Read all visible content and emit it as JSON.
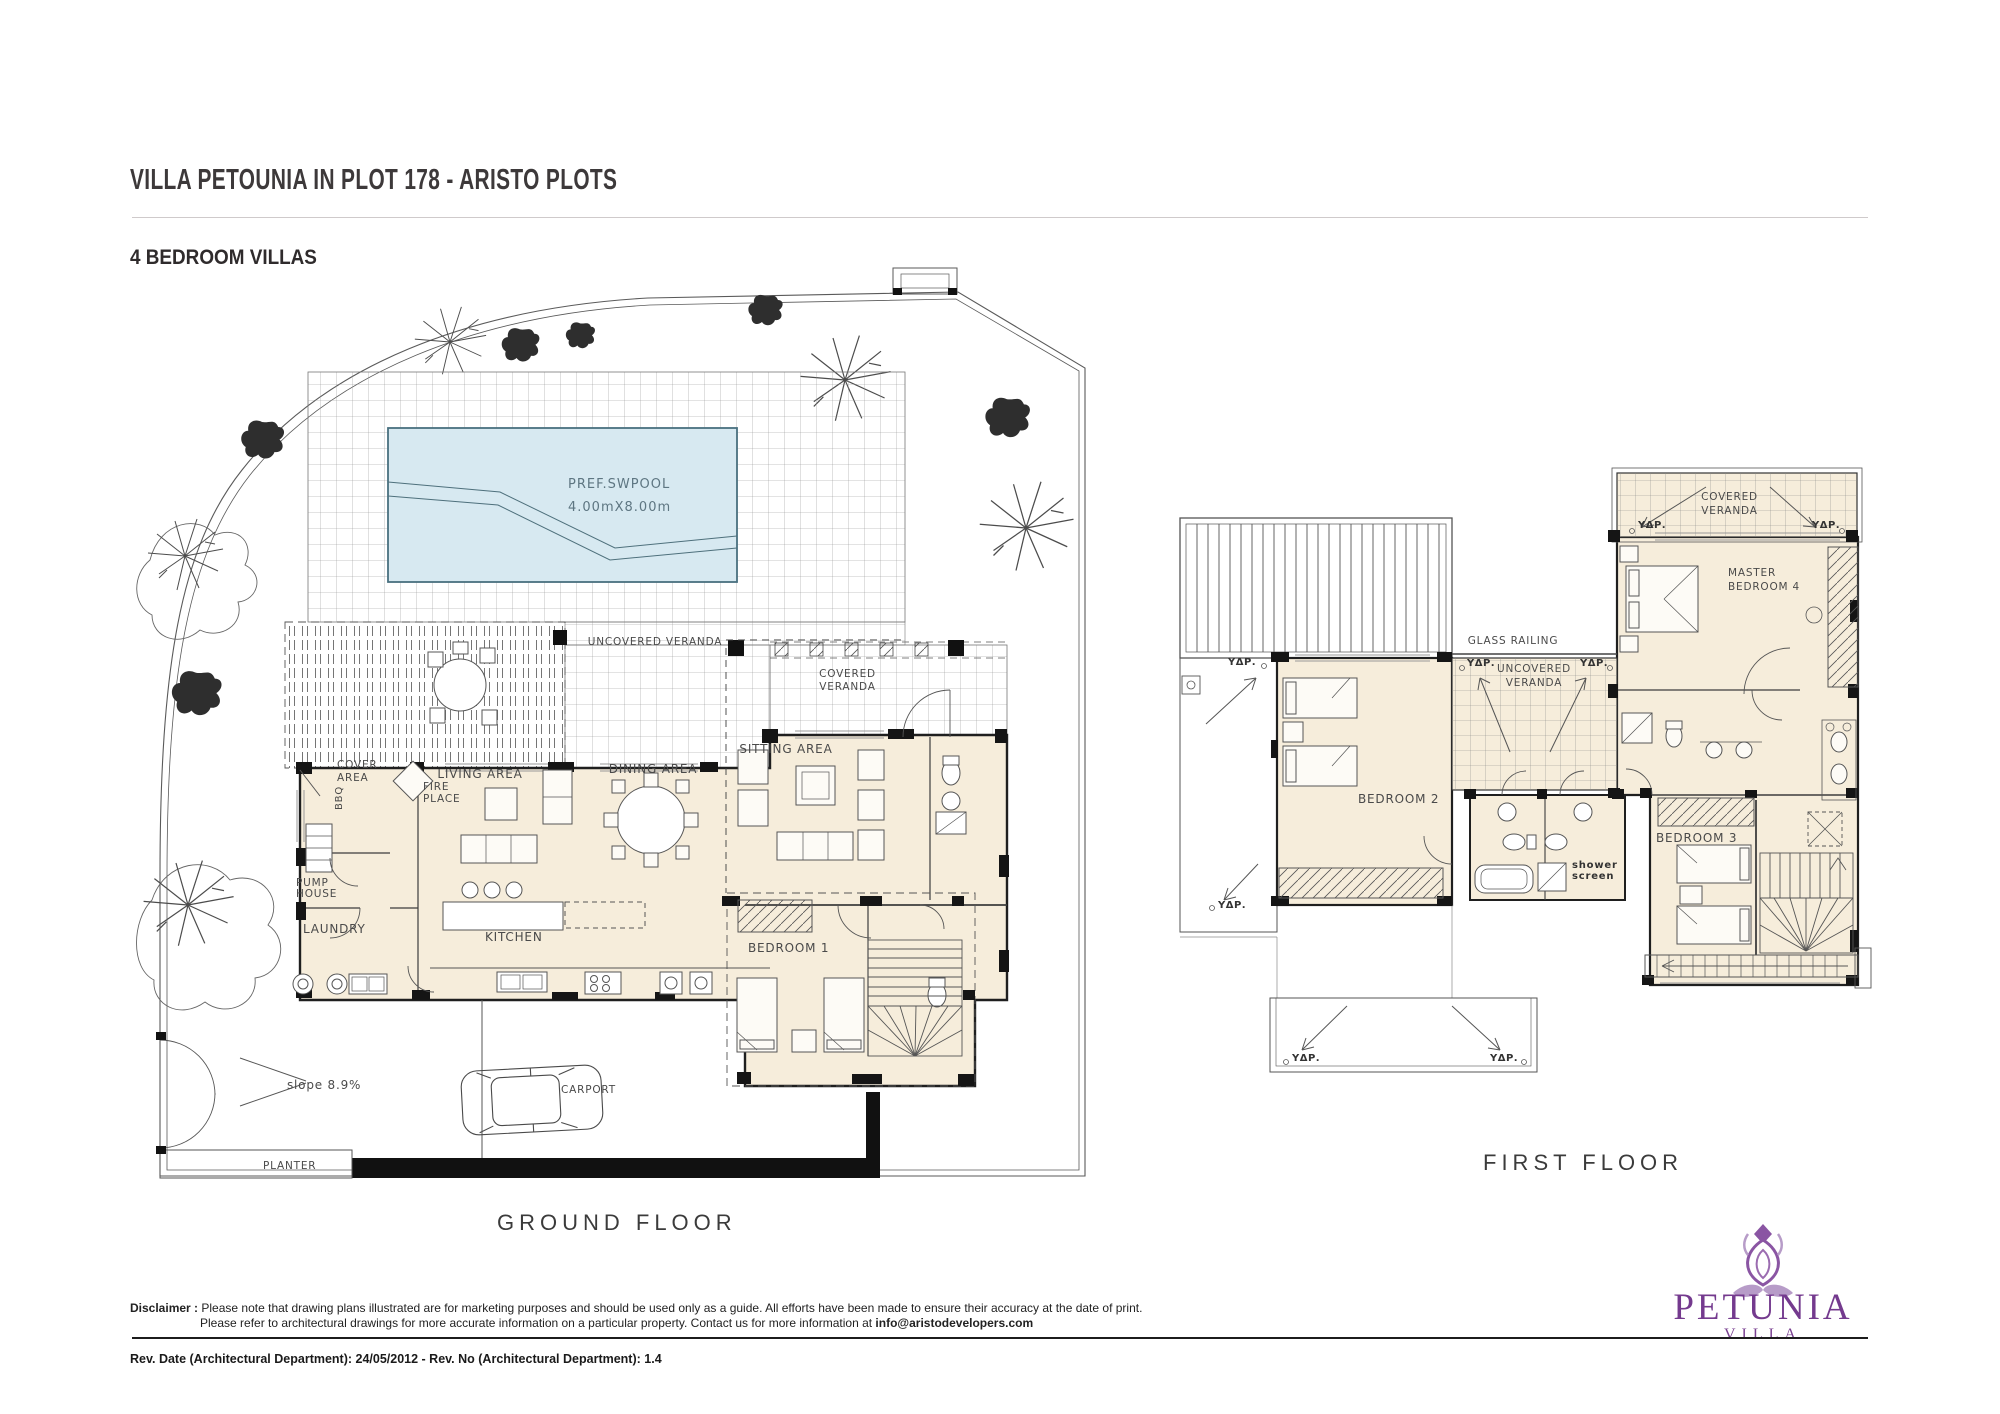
{
  "header": {
    "title": "VILLA PETOUNIA IN PLOT 178 - ARISTO PLOTS",
    "subtitle": "4 BEDROOM VILLAS"
  },
  "ground_floor": {
    "caption": "GROUND FLOOR",
    "labels": {
      "pool": "PREF.SWPOOL",
      "pool_size": "4.00mX8.00m",
      "uncovered_veranda": "UNCOVERED  VERANDA",
      "covered_veranda_1": "COVERED",
      "covered_veranda_2": "VERANDA",
      "sitting_area": "SITTING  AREA",
      "dining_area": "DINING  AREA",
      "living_area": "LIVING  AREA",
      "fire_place_1": "FIRE",
      "fire_place_2": "PLACE",
      "cover_area_1": "COVER",
      "cover_area_2": "AREA",
      "bbq": "BBQ",
      "pump_house_1": "PUMP",
      "pump_house_2": "HOUSE",
      "laundry": "LAUNDRY",
      "kitchen": "KITCHEN",
      "bedroom1": "BEDROOM  1",
      "slope": "slope  8.9%",
      "carport": "CARPORT",
      "planter": "PLANTER"
    }
  },
  "first_floor": {
    "caption": "FIRST FLOOR",
    "labels": {
      "glass_railing": "GLASS  RAILING",
      "uncovered_veranda_1": "UNCOVERED",
      "uncovered_veranda_2": "VERANDA",
      "covered_veranda_1": "COVERED",
      "covered_veranda_2": "VERANDA",
      "master_bedroom_1": "MASTER",
      "master_bedroom_2": "BEDROOM  4",
      "bedroom2": "BEDROOM  2",
      "bedroom3": "BEDROOM  3",
      "shower_screen_1": "shower",
      "shower_screen_2": "screen",
      "ydr": "ΥΔΡ."
    }
  },
  "footer": {
    "disclaimer_label": "Disclaimer :",
    "disclaimer_line1": "Please note that drawing plans illustrated are for marketing purposes and should be used only as a guide. All efforts have been made to ensure their accuracy at the date of print.",
    "disclaimer_line2": "Please refer to architectural drawings for more accurate information on a particular property. Contact us for more information at ",
    "disclaimer_email": "info@aristodevelopers.com",
    "revision": "Rev. Date (Architectural Department): 24/05/2012 - Rev. No (Architectural Department): 1.4"
  },
  "logo": {
    "name": "PETUNIA",
    "type": "VILLA"
  },
  "colors": {
    "floor_fill": "#f6eddb",
    "pool_fill": "#d7e9f1",
    "wall": "#1f1f1f",
    "line": "#4a4a4a",
    "accent_purple": "#7a4191",
    "accent_purple_light": "#b79cc8"
  }
}
